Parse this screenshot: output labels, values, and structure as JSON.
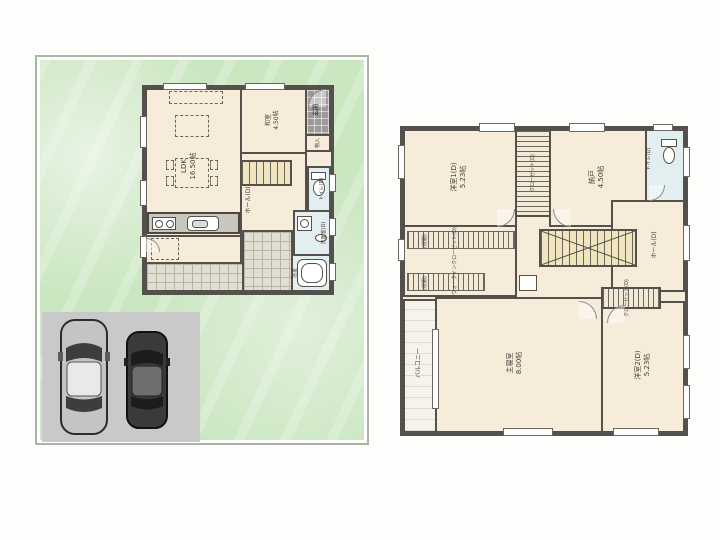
{
  "image": {
    "description": "two-floor Japanese house floor plan, 1F with garden and 2-car parking, 2F plan at right"
  },
  "colors": {
    "lot_green": "#cbe7c2",
    "room_cream": "#f6ecd9",
    "wet_area_blue": "#e3eef0",
    "stair_tan": "#f0e5bf",
    "wall_dark": "#54504b",
    "parking_gray": "#c9c9c9",
    "terrace_tile": "#e2ded2",
    "entry_tile": "#9a9a98"
  },
  "floor1": {
    "labels": {
      "ldk": "LDK\n16.50帖",
      "washitsu": "和室\n4.50帖",
      "genkan": "玄関",
      "monoire": "物入",
      "hall": "ホール(D)",
      "toilet": "トイレ(D)",
      "senmen": "洗面室(D)",
      "bath": "浴室"
    }
  },
  "floor2": {
    "labels": {
      "yoshitsu1": "洋室1(D)\n5.23帖",
      "closet1": "クローゼット(D)",
      "nando": "納戸\n4.50帖",
      "toilet": "トイレ(D)",
      "hall": "ホール(D)",
      "wic": "ウォークインクローゼット(D)",
      "makuradana1": "(枕棚)",
      "makuradana2": "(枕棚)",
      "shinshitsu": "主寝室\n8.00帖",
      "yoshitsu2": "洋室2(D)\n5.23帖",
      "closet2": "クローゼット(D)",
      "balcony": "バルコニー"
    }
  }
}
